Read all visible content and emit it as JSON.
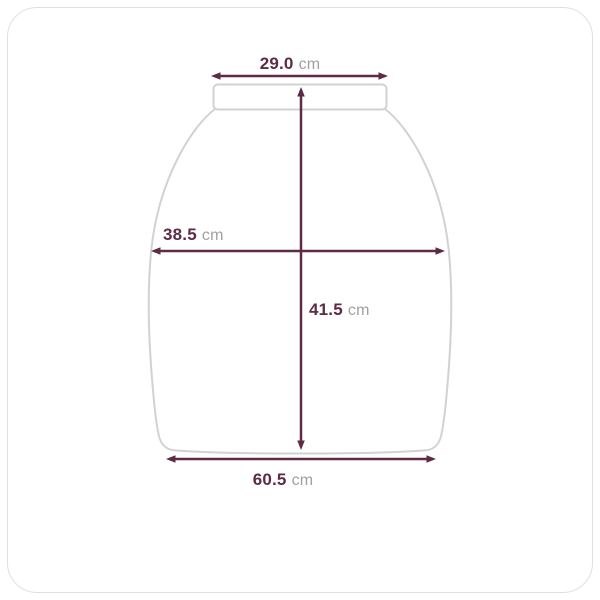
{
  "diagram": {
    "type": "garment-measurement-diagram",
    "measurements": {
      "top_width": {
        "value": "29.0",
        "unit": "cm"
      },
      "middle_width": {
        "value": "38.5",
        "unit": "cm"
      },
      "length": {
        "value": "41.5",
        "unit": "cm"
      },
      "bottom_width": {
        "value": "60.5",
        "unit": "cm"
      }
    },
    "colors": {
      "dimension": "#5d2b46",
      "outline": "#d2d2d2",
      "unit_text": "#9fa0a2",
      "frame_border": "#e0e0e0",
      "background": "#ffffff"
    }
  }
}
